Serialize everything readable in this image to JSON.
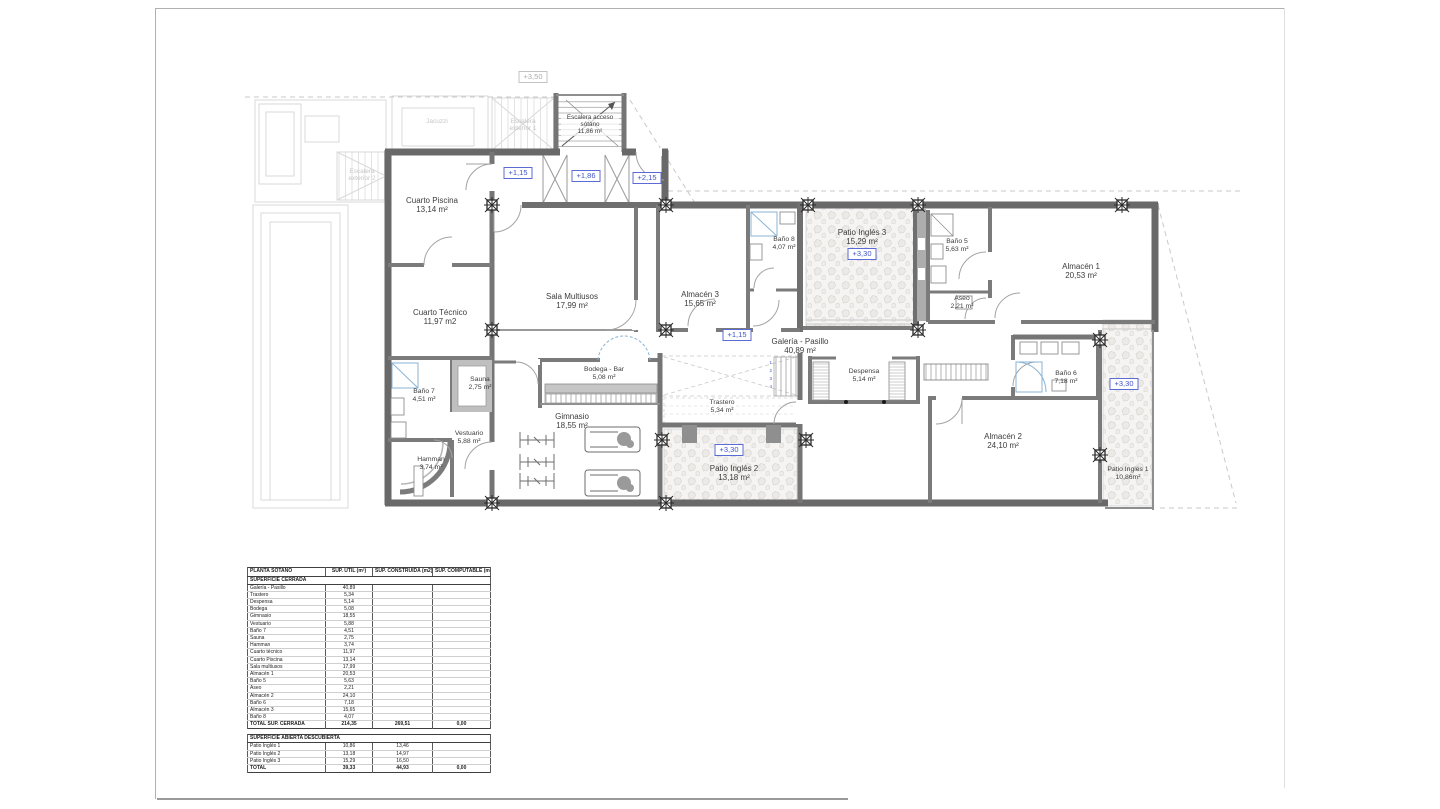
{
  "plan": {
    "rooms": {
      "cuarto_piscina": {
        "name": "Cuarto Piscina",
        "area": "13,14 m²"
      },
      "cuarto_tecnico": {
        "name": "Cuarto Técnico",
        "area": "11,97 m2"
      },
      "bano7": {
        "name": "Baño 7",
        "area": "4,51 m²"
      },
      "sauna": {
        "name": "Sauna",
        "area": "2,75 m²"
      },
      "vestuario": {
        "name": "Vestuario",
        "area": "5,88 m²"
      },
      "hamman": {
        "name": "Hamman",
        "area": "3,74 m²"
      },
      "sala_multiusos": {
        "name": "Sala Multiusos",
        "area": "17,99 m²"
      },
      "bodega_bar": {
        "name": "Bodega - Bar",
        "area": "5,08 m²"
      },
      "gimnasio": {
        "name": "Gimnasio",
        "area": "18,55 m²"
      },
      "almacen3": {
        "name": "Almacén 3",
        "area": "15,65 m²"
      },
      "bano8": {
        "name": "Baño 8",
        "area": "4,07 m²"
      },
      "patio_ingles3": {
        "name": "Patio Inglés 3",
        "area": "15,29 m²"
      },
      "galeria_pasillo": {
        "name": "Galería - Pasillo",
        "area": "40,89 m²"
      },
      "trastero": {
        "name": "Trastero",
        "area": "5,34 m²"
      },
      "despensa": {
        "name": "Despensa",
        "area": "5,14 m²"
      },
      "patio_ingles2": {
        "name": "Patio Inglés 2",
        "area": "13,18 m²"
      },
      "bano5": {
        "name": "Baño 5",
        "area": "5,63 m²"
      },
      "aseo": {
        "name": "Aseo",
        "area": "2,21 m²"
      },
      "almacen1": {
        "name": "Almacén 1",
        "area": "20,53 m²"
      },
      "bano6": {
        "name": "Baño 6",
        "area": "7,18 m²"
      },
      "almacen2": {
        "name": "Almacén 2",
        "area": "24,10 m²"
      },
      "patio_ingles1": {
        "name": "Patio Inglés 1",
        "area": "10,86m²"
      },
      "escalera_sotano": {
        "name": "Escalera acceso sótano",
        "area": "11,86 m²"
      }
    },
    "levels": {
      "plus350": "+3,50",
      "plus115_top": "+1,15",
      "plus186": "+1,86",
      "plus215": "+2,15",
      "plus115_mid": "+1,15",
      "plus330_patio3": "+3,30",
      "plus330_patio2": "+3,30",
      "plus330_patio1": "+3,30"
    },
    "background": {
      "jacuzzi": "Jacuzzi",
      "escalera_ext1": "Escalera exterior 1",
      "escalera_ext2": "Escalera exterior 2"
    },
    "stair_numbers": [
      "1",
      "2",
      "3",
      "4"
    ]
  },
  "table": {
    "headers": [
      "PLANTA SÓTANO",
      "SUP. ÚTIL (m²)",
      "SUP. CONSTRUIDA (m2)",
      "SUP. COMPUTABLE (m2)"
    ],
    "closed": {
      "section": "SUPERFICIE CERRADA",
      "rows": [
        [
          "Galería - Pasillo",
          "40,89",
          "",
          ""
        ],
        [
          "Trastero",
          "5,34",
          "",
          ""
        ],
        [
          "Despensa",
          "5,14",
          "",
          ""
        ],
        [
          "Bodega",
          "5,08",
          "",
          ""
        ],
        [
          "Gimnasio",
          "18,55",
          "",
          ""
        ],
        [
          "Vestuario",
          "5,88",
          "",
          ""
        ],
        [
          "Baño 7",
          "4,51",
          "",
          ""
        ],
        [
          "Sauna",
          "2,75",
          "",
          ""
        ],
        [
          "Hamman",
          "3,74",
          "",
          ""
        ],
        [
          "Cuarto técnico",
          "11,97",
          "",
          ""
        ],
        [
          "Cuarto Piscina",
          "13,14",
          "",
          ""
        ],
        [
          "Sala multiusos",
          "17,99",
          "",
          ""
        ],
        [
          "Almacén 1",
          "20,53",
          "",
          ""
        ],
        [
          "Baño 5",
          "5,63",
          "",
          ""
        ],
        [
          "Aseo",
          "2,21",
          "",
          ""
        ],
        [
          "Almacén 2",
          "24,10",
          "",
          ""
        ],
        [
          "Baño 6",
          "7,18",
          "",
          ""
        ],
        [
          "Almacén 3",
          "15,65",
          "",
          ""
        ],
        [
          "Baño 8",
          "4,07",
          "",
          ""
        ]
      ],
      "total": [
        "TOTAL SUP. CERRADA",
        "214,35",
        "269,51",
        "0,00"
      ]
    },
    "open": {
      "section": "SUPERFICIE ABIERTA DESCUBIERTA",
      "rows": [
        [
          "Patio Inglés 1",
          "10,86",
          "13,46",
          ""
        ],
        [
          "Patio Inglés 2",
          "13,18",
          "14,97",
          ""
        ],
        [
          "Patio Inglés 3",
          "15,29",
          "16,50",
          ""
        ]
      ],
      "total": [
        "TOTAL",
        "39,33",
        "44,93",
        "0,00"
      ]
    }
  }
}
